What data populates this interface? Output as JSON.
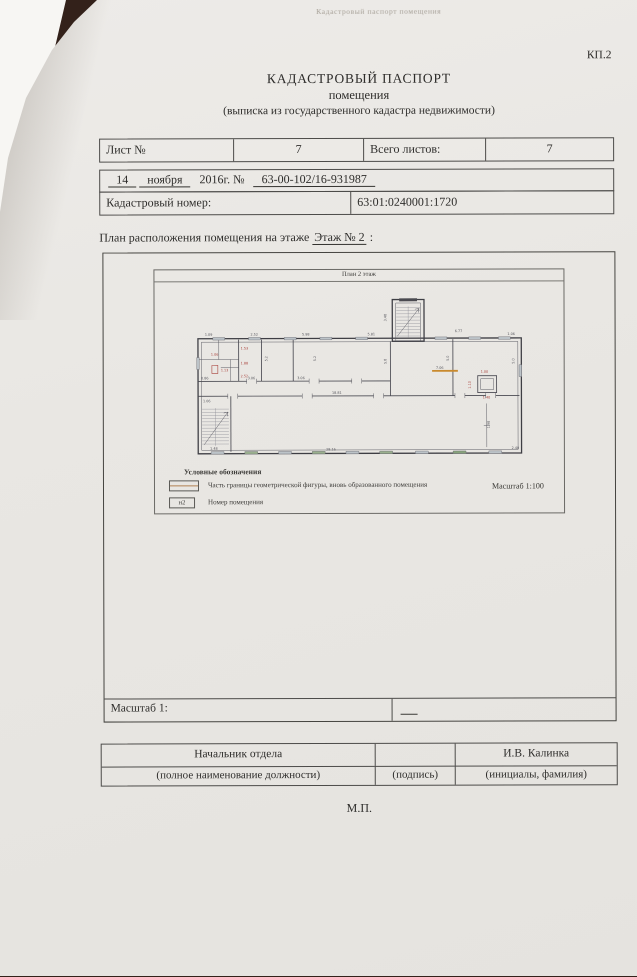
{
  "photo": {
    "background_color": "#33211a",
    "under_sheet_color": "#f7f6f3",
    "paper_color": "#e9e7e3"
  },
  "header": {
    "faint_top_text": "Кадастровый паспорт помещения",
    "form_code": "КП.2",
    "title_line1": "КАДАСТРОВЫЙ ПАСПОРТ",
    "title_line2": "помещения",
    "title_line3": "(выписка из государственного кадастра недвижимости)"
  },
  "sheet_table": {
    "sheet_label": "Лист №",
    "sheet_value": "7",
    "total_label": "Всего листов:",
    "total_value": "7"
  },
  "registration": {
    "day": "14",
    "month": "ноября",
    "year_and_no": "2016г. №",
    "doc_number": "63-00-102/16-931987",
    "cadastral_label": "Кадастровый номер:",
    "cadastral_value": "63:01:0240001:1720"
  },
  "plan_section": {
    "caption_prefix": "План расположения помещения на этаже",
    "caption_floor": "Этаж № 2",
    "caption_suffix": ":",
    "plan_title": "План 2 этаж",
    "legend_title": "Условные обозначения",
    "legend_boundary_label": "Часть границы геометрической фигуры, вновь образованного помещения",
    "legend_number_symbol": "н2",
    "legend_number_label": "Номер помещения",
    "scale_note": "Масштаб 1:100",
    "scale_row_label": "Масштаб 1:",
    "highlight_color": "#c98a2e",
    "dimension_labels": [
      {
        "x": 50,
        "y": 66,
        "t": "1.09",
        "c": "g"
      },
      {
        "x": 96,
        "y": 66,
        "t": "2.52",
        "c": "g"
      },
      {
        "x": 148,
        "y": 66,
        "t": "5.98",
        "c": "g"
      },
      {
        "x": 214,
        "y": 66,
        "t": "5.81",
        "c": "g"
      },
      {
        "x": 302,
        "y": 63,
        "t": "6.77",
        "c": "g"
      },
      {
        "x": 355,
        "y": 66,
        "t": "1.06",
        "c": "g"
      },
      {
        "x": 86,
        "y": 80,
        "t": "1.53",
        "c": "r"
      },
      {
        "x": 56,
        "y": 86,
        "t": "1.06",
        "c": "r"
      },
      {
        "x": 86,
        "y": 95,
        "t": "1.88",
        "c": "r"
      },
      {
        "x": 66,
        "y": 102,
        "t": "1.13",
        "c": "r"
      },
      {
        "x": 86,
        "y": 108,
        "t": "2.52",
        "c": "r"
      },
      {
        "x": 46,
        "y": 110,
        "t": "0.86",
        "c": "g"
      },
      {
        "x": 93,
        "y": 110,
        "t": "3.06",
        "c": "g"
      },
      {
        "x": 143,
        "y": 110,
        "t": "3.06",
        "c": "g"
      },
      {
        "x": 113,
        "y": 92,
        "t": "5.2",
        "c": "g",
        "r": 1
      },
      {
        "x": 162,
        "y": 92,
        "t": "5.2",
        "c": "g",
        "r": 1
      },
      {
        "x": 233,
        "y": 95,
        "t": "5.8",
        "c": "g",
        "r": 1
      },
      {
        "x": 296,
        "y": 92,
        "t": "5.0",
        "c": "g",
        "r": 1
      },
      {
        "x": 362,
        "y": 95,
        "t": "5.0",
        "c": "g",
        "r": 1
      },
      {
        "x": 233,
        "y": 52,
        "t": "3.48",
        "c": "g",
        "r": 1
      },
      {
        "x": 283,
        "y": 100,
        "t": "7.06",
        "c": "g"
      },
      {
        "x": 328,
        "y": 104,
        "t": "1.00",
        "c": "r"
      },
      {
        "x": 318,
        "y": 120,
        "t": "1.10",
        "c": "r",
        "r": 1
      },
      {
        "x": 330,
        "y": 130,
        "t": "1.40",
        "c": "r"
      },
      {
        "x": 337,
        "y": 160,
        "t": "1.98",
        "c": "g",
        "r": 1
      },
      {
        "x": 178,
        "y": 125,
        "t": "18.81",
        "c": "g"
      },
      {
        "x": 172,
        "y": 182,
        "t": "28.16",
        "c": "g"
      },
      {
        "x": 48,
        "y": 133,
        "t": "1.06",
        "c": "g"
      },
      {
        "x": 55,
        "y": 181,
        "t": "1.48",
        "c": "g"
      },
      {
        "x": 359,
        "y": 181,
        "t": "2.40",
        "c": "g"
      }
    ]
  },
  "signature": {
    "position_value": "Начальник отдела",
    "name_value": "И.В. Калинка",
    "position_hint": "(полное наименование должности)",
    "signature_hint": "(подпись)",
    "name_hint": "(инициалы, фамилия)",
    "stamp": "М.П."
  }
}
